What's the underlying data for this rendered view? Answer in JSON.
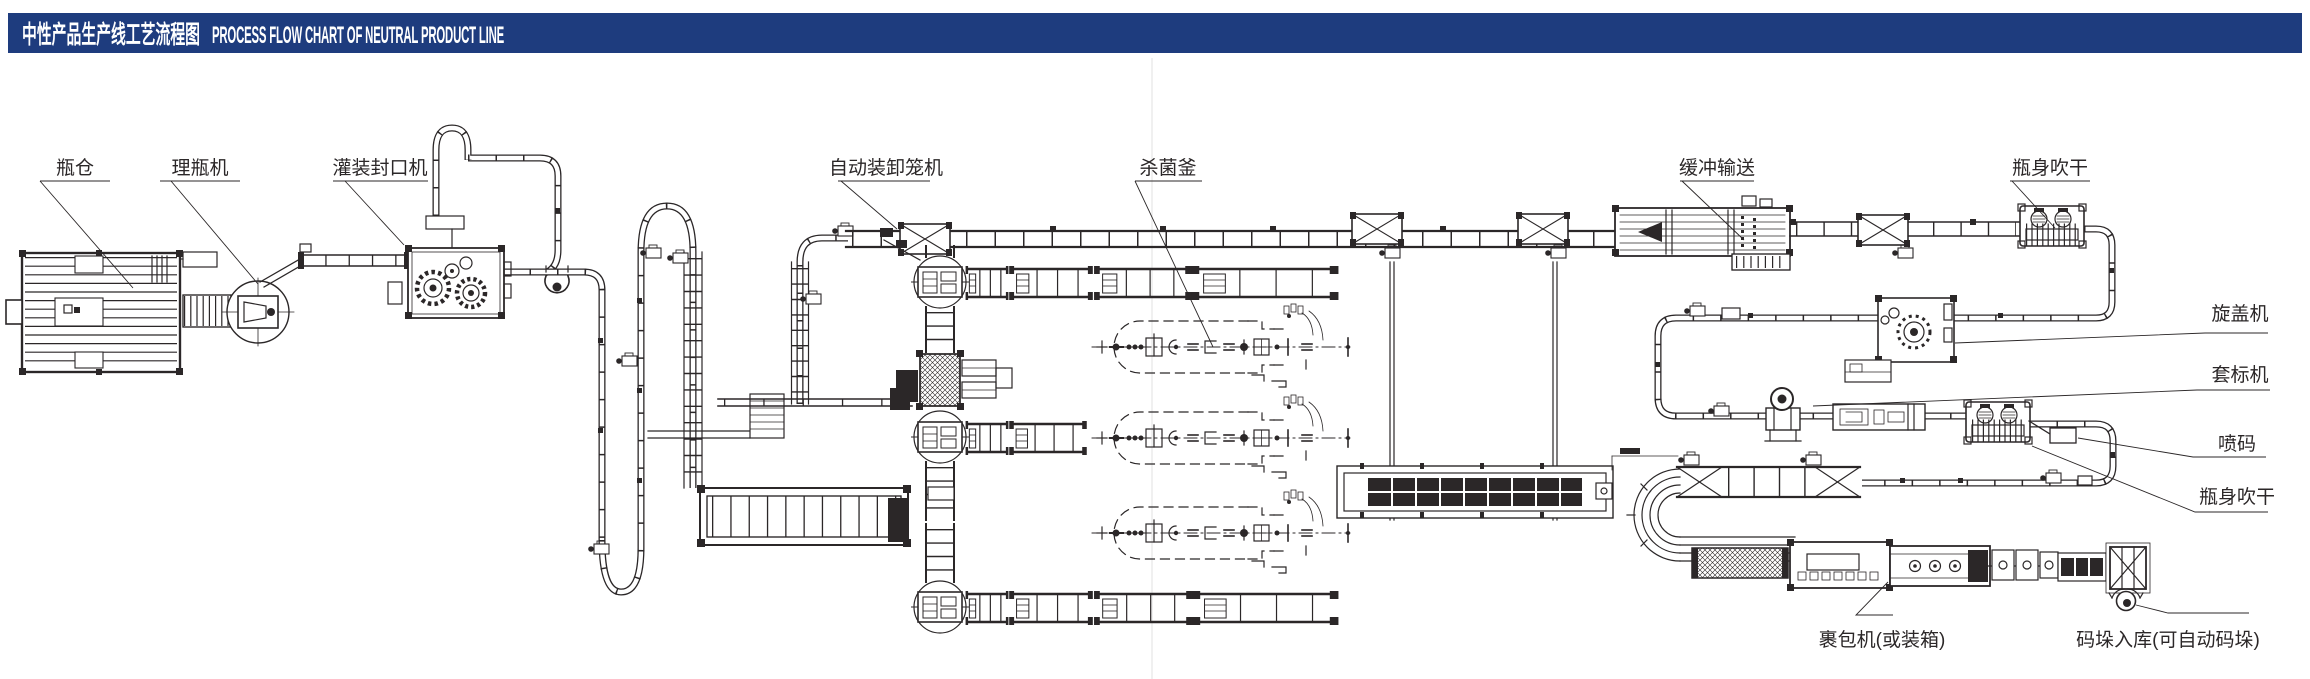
{
  "header": {
    "title_zh": "中性产品生产线工艺流程图",
    "title_en": "PROCESS FLOW CHART OF NEUTRAL PRODUCT LINE",
    "bar_color": "#1e3c7e",
    "text_color": "#ffffff"
  },
  "colors": {
    "ink": "#2b2728",
    "background": "#ffffff",
    "crease": "#e7e7e7"
  },
  "labels": [
    {
      "id": "bottle-silo",
      "text": "瓶仓"
    },
    {
      "id": "bottle-unscrambler",
      "text": "理瓶机"
    },
    {
      "id": "filling-capping-machine",
      "text": "灌装封口机"
    },
    {
      "id": "auto-cage-loader",
      "text": "自动装卸笼机"
    },
    {
      "id": "sterilization-retort",
      "text": "杀菌釜"
    },
    {
      "id": "buffer-conveyor",
      "text": "缓冲输送"
    },
    {
      "id": "bottle-body-drying-top",
      "text": "瓶身吹干"
    },
    {
      "id": "capping-machine",
      "text": "旋盖机"
    },
    {
      "id": "sleeve-labeler",
      "text": "套标机"
    },
    {
      "id": "inkjet-coder",
      "text": "喷码"
    },
    {
      "id": "bottle-body-drying-right",
      "text": "瓶身吹干"
    },
    {
      "id": "wrapping-machine",
      "text": "裹包机(或装箱)"
    },
    {
      "id": "palletizing-warehouse",
      "text": "码垛入库(可自动码垛)"
    }
  ]
}
